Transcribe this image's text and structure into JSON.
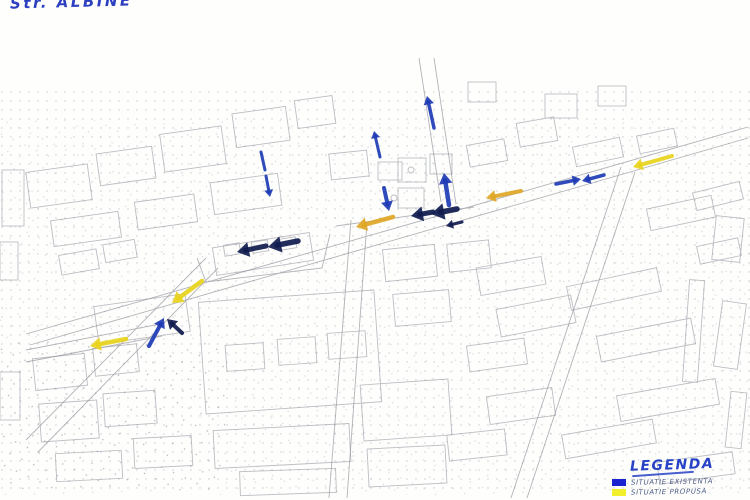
{
  "header": {
    "street_label": "Str. ALBINE"
  },
  "legend": {
    "title": "LEGENDA",
    "items": [
      {
        "label": "SITUATIE EXISTENTA",
        "color": "#1a23d0"
      },
      {
        "label": "SITUATIE PROPUSA",
        "color": "#f2ef2d"
      }
    ]
  },
  "palette": {
    "blue": "#1e3bb5",
    "navy": "#111c4f",
    "yellow": "#e9d41d",
    "orange": "#dfa726"
  },
  "annotations": {
    "arrows": [
      {
        "id": "flow-up-north-top",
        "color": "blue",
        "tail": [
          434,
          128
        ],
        "tip": [
          427,
          96
        ],
        "w": 3.5,
        "head": true
      },
      {
        "id": "flow-up-mid-top",
        "color": "blue",
        "tail": [
          380,
          157
        ],
        "tip": [
          374,
          131
        ],
        "w": 3,
        "head": true
      },
      {
        "id": "flow-down-dash-1",
        "color": "blue",
        "tail": [
          261,
          152
        ],
        "tip": [
          265,
          170
        ],
        "w": 3,
        "head": false
      },
      {
        "id": "flow-down-dash-2",
        "color": "blue",
        "tail": [
          266,
          176
        ],
        "tip": [
          270,
          197
        ],
        "w": 3,
        "head": true
      },
      {
        "id": "flow-up-intersection",
        "color": "blue",
        "tail": [
          449,
          205
        ],
        "tip": [
          444,
          173
        ],
        "w": 4.5,
        "head": true
      },
      {
        "id": "flow-down-intersection",
        "color": "blue",
        "tail": [
          384,
          188
        ],
        "tip": [
          389,
          211
        ],
        "w": 4,
        "head": true
      },
      {
        "id": "flow-left-thick-east-1",
        "color": "navy",
        "tail": [
          457,
          209
        ],
        "tip": [
          431,
          214
        ],
        "w": 5.5,
        "head": true
      },
      {
        "id": "flow-left-thick-east-2",
        "color": "navy",
        "tail": [
          433,
          212
        ],
        "tip": [
          411,
          216
        ],
        "w": 5,
        "head": true
      },
      {
        "id": "flow-left-small",
        "color": "navy",
        "tail": [
          462,
          222
        ],
        "tip": [
          446,
          226
        ],
        "w": 3,
        "head": true
      },
      {
        "id": "flow-left-thick-west-1",
        "color": "navy",
        "tail": [
          298,
          241
        ],
        "tip": [
          268,
          247
        ],
        "w": 5.5,
        "head": true
      },
      {
        "id": "flow-left-thick-west-2",
        "color": "navy",
        "tail": [
          266,
          246
        ],
        "tip": [
          237,
          252
        ],
        "w": 5,
        "head": true
      },
      {
        "id": "flow-right-east",
        "color": "blue",
        "tail": [
          556,
          184
        ],
        "tip": [
          581,
          179
        ],
        "w": 3.5,
        "head": true
      },
      {
        "id": "flow-left-east",
        "color": "blue",
        "tail": [
          604,
          175
        ],
        "tip": [
          582,
          181
        ],
        "w": 3.5,
        "head": true
      },
      {
        "id": "flow-up-southwest",
        "color": "blue",
        "tail": [
          149,
          346
        ],
        "tip": [
          164,
          318
        ],
        "w": 4,
        "head": true
      },
      {
        "id": "flow-upleft-southwest",
        "color": "navy",
        "tail": [
          182,
          333
        ],
        "tip": [
          167,
          319
        ],
        "w": 4,
        "head": true
      },
      {
        "id": "proposed-left-far-west",
        "color": "yellow",
        "tail": [
          126,
          339
        ],
        "tip": [
          90,
          346
        ],
        "w": 4.5,
        "head": true
      },
      {
        "id": "proposed-downleft-west",
        "color": "yellow",
        "tail": [
          202,
          281
        ],
        "tip": [
          172,
          303
        ],
        "w": 4.5,
        "head": true
      },
      {
        "id": "proposed-left-center",
        "color": "orange",
        "tail": [
          393,
          217
        ],
        "tip": [
          356,
          227
        ],
        "w": 4.5,
        "head": true
      },
      {
        "id": "proposed-left-midright",
        "color": "orange",
        "tail": [
          521,
          191
        ],
        "tip": [
          486,
          198
        ],
        "w": 4,
        "head": true
      },
      {
        "id": "proposed-left-far-east",
        "color": "yellow",
        "tail": [
          672,
          156
        ],
        "tip": [
          633,
          167
        ],
        "w": 4,
        "head": true
      }
    ]
  }
}
